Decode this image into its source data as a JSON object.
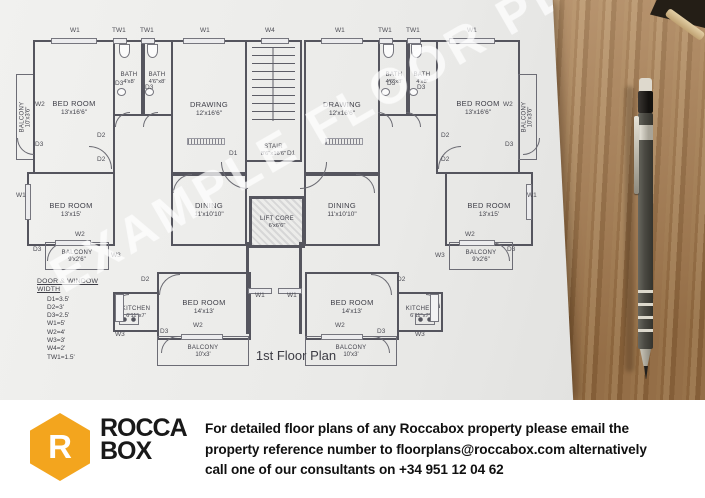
{
  "photo": {
    "watermark": "EXAMPLE FLOOR PLAN",
    "caption": "1st Floor Plan"
  },
  "plan": {
    "rooms": [
      {
        "id": "balcony-top-left",
        "name": "BALCONY",
        "size": "10'x3'6\""
      },
      {
        "id": "bedroom-top-left",
        "name": "BED ROOM",
        "size": "13'x16'6\""
      },
      {
        "id": "bath-left-a",
        "name": "BATH",
        "size": "4'x8'"
      },
      {
        "id": "bath-left-b",
        "name": "BATH",
        "size": "4'6\"x8'"
      },
      {
        "id": "drawing-left",
        "name": "DRAWING",
        "size": "12'x16'6\""
      },
      {
        "id": "stair",
        "name": "STAIR",
        "size": "8'6\"x16'6\""
      },
      {
        "id": "drawing-right",
        "name": "DRAWING",
        "size": "12'x16'6\""
      },
      {
        "id": "bath-right-a",
        "name": "BATH",
        "size": "4'6\"x8'"
      },
      {
        "id": "bath-right-b",
        "name": "BATH",
        "size": "4'x8'"
      },
      {
        "id": "bedroom-top-right",
        "name": "BED ROOM",
        "size": "13'x16'6\""
      },
      {
        "id": "balcony-top-right",
        "name": "BALCONY",
        "size": "10'x3'6\""
      },
      {
        "id": "bedroom-mid-left",
        "name": "BED ROOM",
        "size": "13'x15'"
      },
      {
        "id": "dining-left",
        "name": "DINING",
        "size": "11'x10'10\""
      },
      {
        "id": "lift-core",
        "name": "LIFT CORE",
        "size": "6'x6'6\""
      },
      {
        "id": "dining-right",
        "name": "DINING",
        "size": "11'x10'10\""
      },
      {
        "id": "bedroom-mid-right",
        "name": "BED ROOM",
        "size": "13'x15'"
      },
      {
        "id": "balcony-mid-left",
        "name": "BALCONY",
        "size": "9'x2'6\""
      },
      {
        "id": "balcony-mid-right",
        "name": "BALCONY",
        "size": "9'x2'6\""
      },
      {
        "id": "kitchen-left",
        "name": "KITCHEN",
        "size": "6'11\"x7'"
      },
      {
        "id": "bedroom-bottom-left",
        "name": "BED ROOM",
        "size": "14'x13'"
      },
      {
        "id": "bedroom-bottom-right",
        "name": "BED ROOM",
        "size": "14'x13'"
      },
      {
        "id": "kitchen-right",
        "name": "KITCHEN",
        "size": "6'11\"x7'"
      },
      {
        "id": "balcony-bottom-left",
        "name": "BALCONY",
        "size": "10'x3'"
      },
      {
        "id": "balcony-bottom-right",
        "name": "BALCONY",
        "size": "10'x3'"
      }
    ],
    "legend": {
      "title": "DOOR & WINDOW WIDTH",
      "items": [
        "D1=3.5'",
        "D2=3'",
        "D3=2.5'",
        "W1=5'",
        "W2=4'",
        "W3=3'",
        "W4=2'",
        "TW1=1.5'"
      ]
    },
    "tags": [
      "W1",
      "TW1",
      "TW1",
      "W1",
      "W4",
      "W1",
      "TW1",
      "TW1",
      "W1",
      "W2",
      "D3",
      "W1",
      "W2",
      "D3",
      "W3",
      "W2",
      "D3",
      "W1",
      "W2",
      "D3",
      "W3",
      "D2",
      "D2",
      "D3",
      "D3",
      "D1",
      "D1",
      "D3",
      "D3",
      "D2",
      "D2",
      "D2",
      "W1",
      "W1",
      "D2",
      "W2",
      "D3",
      "W2",
      "D3",
      "W3",
      "W3"
    ]
  },
  "footer": {
    "logo": {
      "mark": "R",
      "line1": "ROCCA",
      "line2": "BOX"
    },
    "text_line1": "For detailed floor plans of any Roccabox property please email the",
    "text_line2": "property reference number to floorplans@roccabox.com alternatively",
    "text_line3": "call one of our consultants on +34 951 12 04 62"
  },
  "colors": {
    "accent": "#F3A51E",
    "plan_ink": "#55555e",
    "wood": "#a87c4e"
  }
}
